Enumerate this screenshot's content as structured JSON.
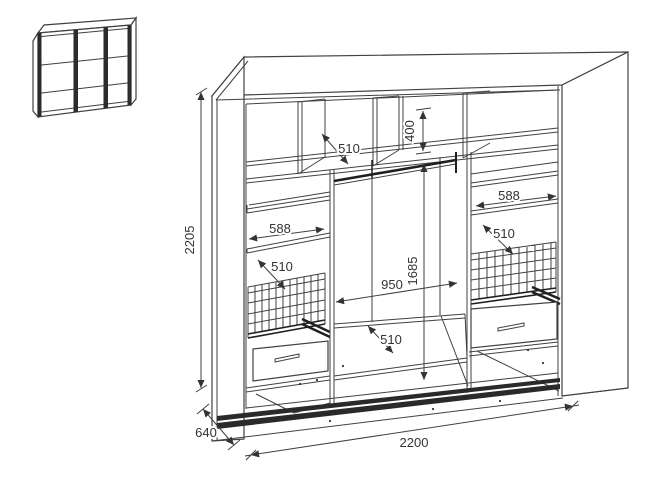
{
  "figure": {
    "thumbnail_name": "wardrobe-front-view",
    "main_name": "wardrobe-interior-dimensioned-view"
  },
  "colors": {
    "line": "#414141",
    "dark": "#1f1f1f",
    "text": "#333333",
    "background": "#ffffff"
  },
  "dimensions_mm": {
    "overall_height": "2205",
    "overall_width": "2200",
    "overall_depth": "640",
    "top_shelf_depth": "510",
    "upper_compartment_height": "400",
    "left_section_width": "588",
    "left_shelf_depth": "510",
    "right_section_width": "588",
    "right_shelf_depth": "510",
    "hanging_section_width": "950",
    "hanging_section_height": "1685",
    "bottom_shelf_depth": "510"
  }
}
